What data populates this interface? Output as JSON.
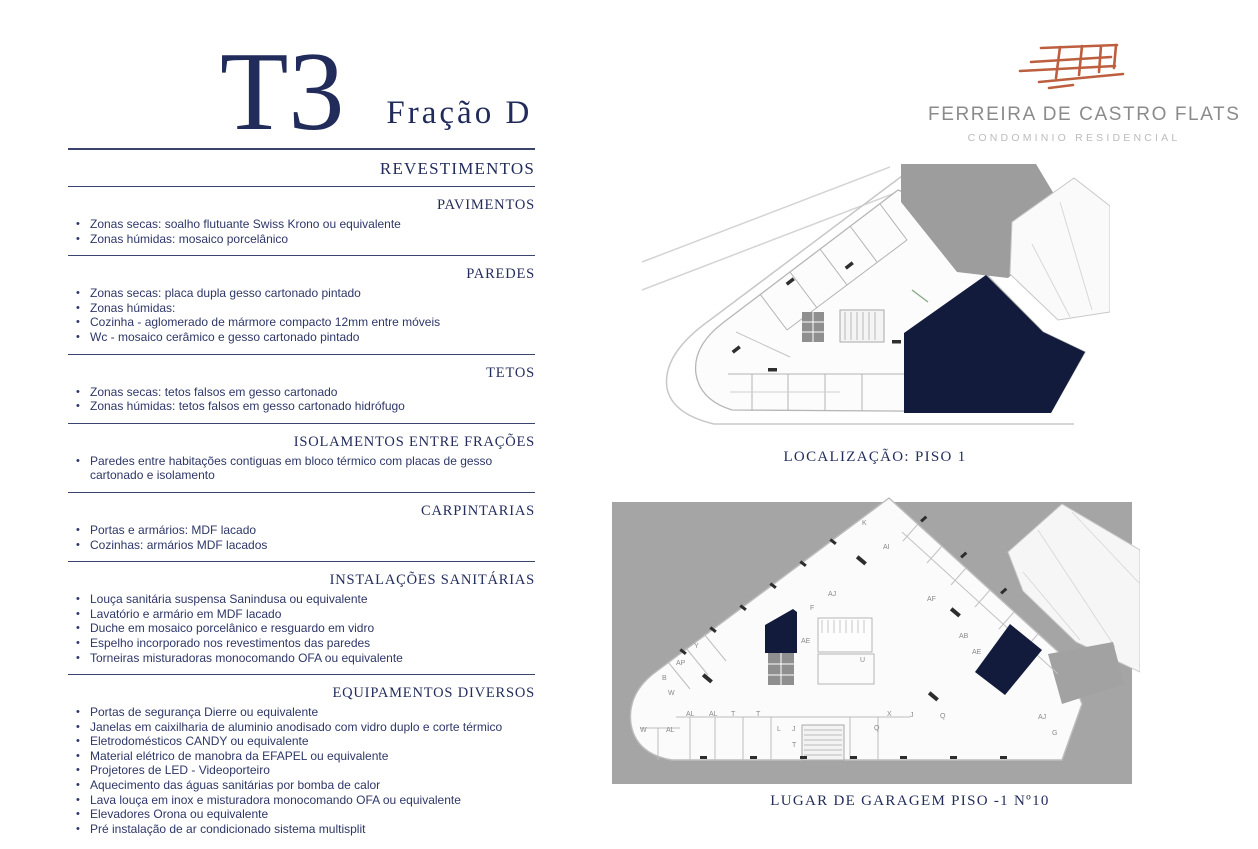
{
  "page": {
    "title_unit": "T3",
    "title_fraction": "Fração D"
  },
  "logo": {
    "name": "FERREIRA DE CASTRO FLATS",
    "subtitle": "CONDOMINIO RESIDENCIAL",
    "sketch_icon": "boat-sketch-icon",
    "accent_color": "#bd5f3f",
    "name_color": "#8b8b8b",
    "subtitle_color": "#bcbcbc"
  },
  "colors": {
    "text_navy": "#2e3767",
    "heading_navy": "#232d5c",
    "rule_navy": "#3a426e",
    "highlight_navy": "#121b3c",
    "plan_background_gray": "#a5a5a5"
  },
  "spec": {
    "main_heading": "REVESTIMENTOS",
    "sections": [
      {
        "heading": "PAVIMENTOS",
        "items": [
          "Zonas secas: soalho flutuante Swiss Krono ou equivalente",
          "Zonas húmidas: mosaico porcelânico"
        ]
      },
      {
        "heading": "PAREDES",
        "items": [
          "Zonas secas: placa dupla gesso cartonado pintado",
          "Zonas húmidas:",
          "Cozinha - aglomerado de mármore compacto 12mm entre móveis",
          "Wc - mosaico cerâmico e gesso cartonado pintado"
        ]
      },
      {
        "heading": "TETOS",
        "items": [
          "Zonas secas: tetos falsos em gesso cartonado",
          "Zonas húmidas: tetos falsos em gesso cartonado hidrófugo"
        ]
      },
      {
        "heading": "ISOLAMENTOS ENTRE FRAÇÕES",
        "items": [
          "Paredes entre habitações contiguas em bloco térmico com placas de gesso cartonado e isolamento"
        ]
      },
      {
        "heading": "CARPINTARIAS",
        "items": [
          "Portas e armários: MDF lacado",
          "Cozinhas: armários MDF lacados"
        ]
      },
      {
        "heading": "INSTALAÇÕES SANITÁRIAS",
        "items": [
          "Louça sanitária suspensa Sanindusa ou equivalente",
          "Lavatório e armário em MDF lacado",
          "Duche em mosaico porcelânico e resguardo em vidro",
          "Espelho incorporado nos revestimentos das paredes",
          "Torneiras misturadoras monocomando OFA ou equivalente"
        ]
      },
      {
        "heading": "EQUIPAMENTOS DIVERSOS",
        "items": [
          "Portas de segurança Dierre ou equivalente",
          "Janelas em caixilharia de aluminio anodisado com vidro duplo e corte térmico",
          "Eletrodomésticos CANDY ou equivalente",
          "Material elétrico de manobra da EFAPEL ou equivalente",
          "Projetores de LED - Videoporteiro",
          "Aquecimento das águas sanitárias por bomba de calor",
          "Lava louça em inox e misturadora monocomando OFA ou equivalente",
          "Elevadores Orona ou equivalente",
          "Pré instalação de ar condicionado sistema multisplit"
        ]
      }
    ]
  },
  "plans": [
    {
      "caption": "LOCALIZAÇÃO: PISO 1",
      "highlight": "fraction-d-unit"
    },
    {
      "caption": "LUGAR DE GARAGEM PISO -1 Nº10",
      "highlight": "garage-spot-10",
      "labels": [
        {
          "t": "K",
          "x": 252,
          "y": 33
        },
        {
          "t": "AI",
          "x": 273,
          "y": 57
        },
        {
          "t": "AF",
          "x": 317,
          "y": 109
        },
        {
          "t": "AB",
          "x": 349,
          "y": 146
        },
        {
          "t": "AE",
          "x": 362,
          "y": 162
        },
        {
          "t": "AJ",
          "x": 218,
          "y": 104
        },
        {
          "t": "F",
          "x": 200,
          "y": 118
        },
        {
          "t": "AE",
          "x": 191,
          "y": 151
        },
        {
          "t": "U",
          "x": 250,
          "y": 170
        },
        {
          "t": "Y",
          "x": 84,
          "y": 156
        },
        {
          "t": "AP",
          "x": 66,
          "y": 173
        },
        {
          "t": "B",
          "x": 52,
          "y": 188
        },
        {
          "t": "W",
          "x": 58,
          "y": 203
        },
        {
          "t": "W",
          "x": 30,
          "y": 240
        },
        {
          "t": "AL",
          "x": 56,
          "y": 240
        },
        {
          "t": "AL",
          "x": 76,
          "y": 224
        },
        {
          "t": "AL",
          "x": 99,
          "y": 224
        },
        {
          "t": "T",
          "x": 121,
          "y": 224
        },
        {
          "t": "T",
          "x": 146,
          "y": 224
        },
        {
          "t": "L",
          "x": 167,
          "y": 239
        },
        {
          "t": "J",
          "x": 182,
          "y": 239
        },
        {
          "t": "T",
          "x": 182,
          "y": 255
        },
        {
          "t": "Q",
          "x": 264,
          "y": 238
        },
        {
          "t": "X",
          "x": 277,
          "y": 224
        },
        {
          "t": "J",
          "x": 300,
          "y": 225
        },
        {
          "t": "Q",
          "x": 330,
          "y": 226
        },
        {
          "t": "AJ",
          "x": 428,
          "y": 227
        },
        {
          "t": "G",
          "x": 442,
          "y": 243
        }
      ]
    }
  ]
}
